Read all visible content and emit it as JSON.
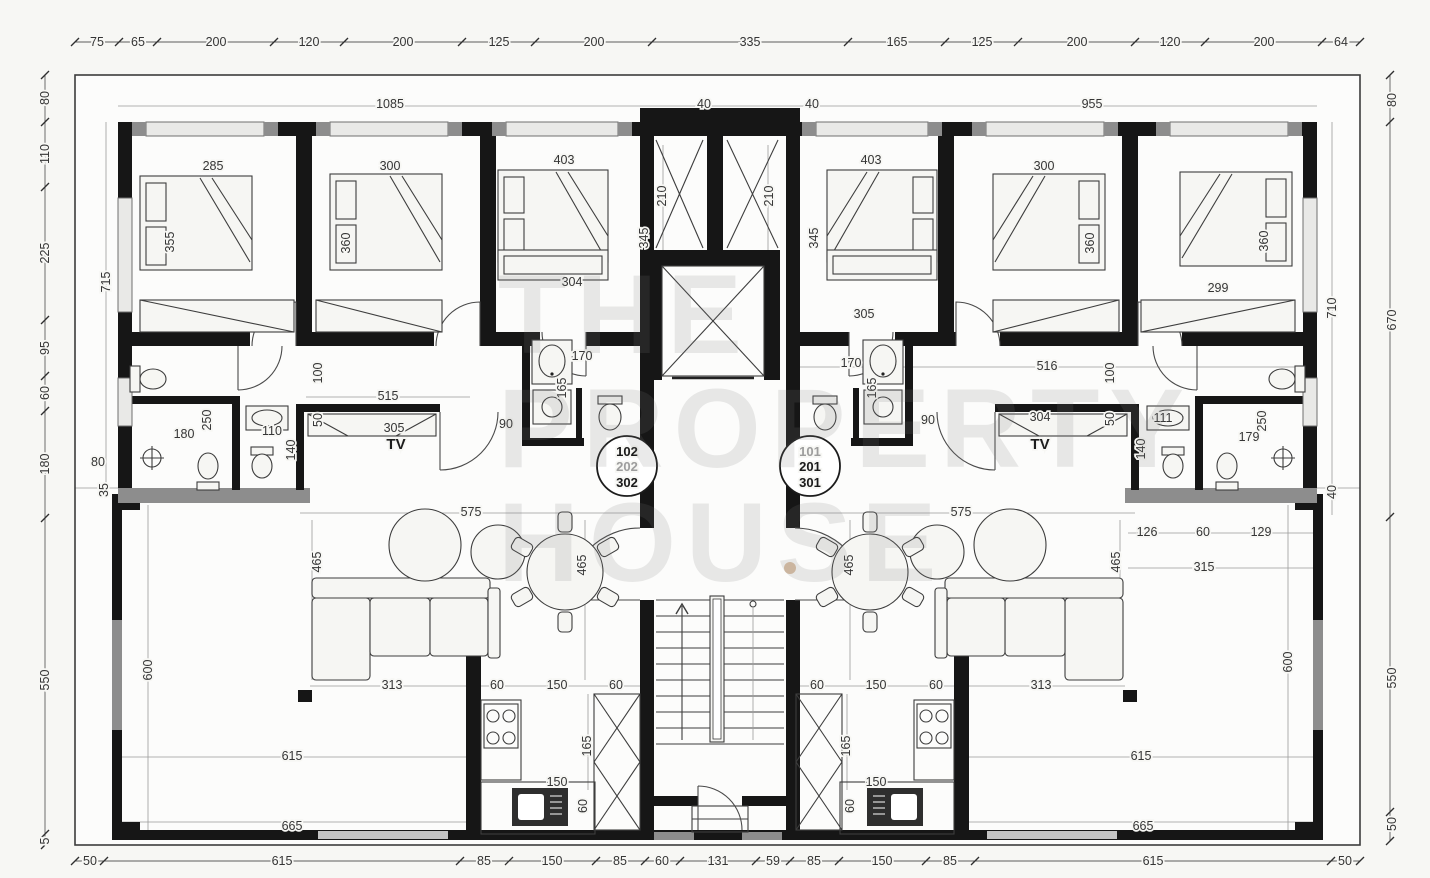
{
  "watermark": {
    "line1": "THE",
    "line2": "PROPERTY",
    "line3": "HOUSE"
  },
  "plan": {
    "kind": "apartment-floor-plan",
    "unit_stacks": {
      "left": [
        "102",
        "202",
        "302"
      ],
      "right": [
        "101",
        "201",
        "301"
      ]
    },
    "room_tags": [
      "TV",
      "TV"
    ]
  },
  "labels": [
    {
      "t": "75",
      "x": 97,
      "y": 42
    },
    {
      "t": "65",
      "x": 138,
      "y": 42
    },
    {
      "t": "200",
      "x": 216,
      "y": 42
    },
    {
      "t": "120",
      "x": 309,
      "y": 42
    },
    {
      "t": "200",
      "x": 403,
      "y": 42
    },
    {
      "t": "125",
      "x": 499,
      "y": 42
    },
    {
      "t": "200",
      "x": 594,
      "y": 42
    },
    {
      "t": "335",
      "x": 750,
      "y": 42
    },
    {
      "t": "165",
      "x": 897,
      "y": 42
    },
    {
      "t": "125",
      "x": 982,
      "y": 42
    },
    {
      "t": "200",
      "x": 1077,
      "y": 42
    },
    {
      "t": "120",
      "x": 1170,
      "y": 42
    },
    {
      "t": "200",
      "x": 1264,
      "y": 42
    },
    {
      "t": "64",
      "x": 1341,
      "y": 42
    },
    {
      "t": "50",
      "x": 90,
      "y": 861
    },
    {
      "t": "615",
      "x": 282,
      "y": 861
    },
    {
      "t": "85",
      "x": 484,
      "y": 861
    },
    {
      "t": "150",
      "x": 552,
      "y": 861
    },
    {
      "t": "85",
      "x": 620,
      "y": 861
    },
    {
      "t": "60",
      "x": 662,
      "y": 861
    },
    {
      "t": "131",
      "x": 718,
      "y": 861
    },
    {
      "t": "59",
      "x": 773,
      "y": 861
    },
    {
      "t": "85",
      "x": 814,
      "y": 861
    },
    {
      "t": "150",
      "x": 882,
      "y": 861
    },
    {
      "t": "85",
      "x": 950,
      "y": 861
    },
    {
      "t": "615",
      "x": 1153,
      "y": 861
    },
    {
      "t": "50",
      "x": 1345,
      "y": 861
    },
    {
      "t": "80",
      "x": 45,
      "y": 98,
      "r": 1
    },
    {
      "t": "110",
      "x": 45,
      "y": 154,
      "r": 1
    },
    {
      "t": "225",
      "x": 45,
      "y": 253,
      "r": 1
    },
    {
      "t": "95",
      "x": 45,
      "y": 348,
      "r": 1
    },
    {
      "t": "60",
      "x": 45,
      "y": 393,
      "r": 1
    },
    {
      "t": "180",
      "x": 45,
      "y": 464,
      "r": 1
    },
    {
      "t": "550",
      "x": 45,
      "y": 680,
      "r": 1
    },
    {
      "t": "5",
      "x": 45,
      "y": 841,
      "r": 1
    },
    {
      "t": "80",
      "x": 1392,
      "y": 100,
      "r": 1
    },
    {
      "t": "670",
      "x": 1392,
      "y": 320,
      "r": 1
    },
    {
      "t": "550",
      "x": 1392,
      "y": 678,
      "r": 1
    },
    {
      "t": "50",
      "x": 1392,
      "y": 824,
      "r": 1
    },
    {
      "t": "1085",
      "x": 390,
      "y": 104
    },
    {
      "t": "40",
      "x": 704,
      "y": 104
    },
    {
      "t": "40",
      "x": 812,
      "y": 104
    },
    {
      "t": "955",
      "x": 1092,
      "y": 104
    },
    {
      "t": "715",
      "x": 106,
      "y": 282,
      "r": 1
    },
    {
      "t": "80",
      "x": 98,
      "y": 462
    },
    {
      "t": "35",
      "x": 104,
      "y": 490,
      "r": 1
    },
    {
      "t": "600",
      "x": 148,
      "y": 670,
      "r": 1
    },
    {
      "t": "665",
      "x": 292,
      "y": 826
    },
    {
      "t": "710",
      "x": 1332,
      "y": 308,
      "r": 1
    },
    {
      "t": "40",
      "x": 1332,
      "y": 492,
      "r": 1
    },
    {
      "t": "600",
      "x": 1288,
      "y": 662,
      "r": 1
    },
    {
      "t": "665",
      "x": 1143,
      "y": 826
    },
    {
      "t": "285",
      "x": 213,
      "y": 166
    },
    {
      "t": "355",
      "x": 170,
      "y": 242,
      "r": 1
    },
    {
      "t": "300",
      "x": 390,
      "y": 166
    },
    {
      "t": "360",
      "x": 346,
      "y": 243,
      "r": 1
    },
    {
      "t": "403",
      "x": 564,
      "y": 160
    },
    {
      "t": "304",
      "x": 572,
      "y": 282
    },
    {
      "t": "210",
      "x": 662,
      "y": 196,
      "r": 1
    },
    {
      "t": "345",
      "x": 644,
      "y": 238,
      "r": 1
    },
    {
      "t": "210",
      "x": 769,
      "y": 196,
      "r": 1
    },
    {
      "t": "345",
      "x": 814,
      "y": 238,
      "r": 1
    },
    {
      "t": "403",
      "x": 871,
      "y": 160
    },
    {
      "t": "305",
      "x": 864,
      "y": 314
    },
    {
      "t": "300",
      "x": 1044,
      "y": 166
    },
    {
      "t": "360",
      "x": 1090,
      "y": 243,
      "r": 1
    },
    {
      "t": "299",
      "x": 1218,
      "y": 288
    },
    {
      "t": "360",
      "x": 1264,
      "y": 241,
      "r": 1
    },
    {
      "t": "100",
      "x": 318,
      "y": 373,
      "r": 1
    },
    {
      "t": "515",
      "x": 388,
      "y": 396
    },
    {
      "t": "50",
      "x": 318,
      "y": 420,
      "r": 1
    },
    {
      "t": "305",
      "x": 394,
      "y": 428
    },
    {
      "t": "TV",
      "x": 396,
      "y": 445,
      "c": "tv"
    },
    {
      "t": "250",
      "x": 207,
      "y": 420,
      "r": 1
    },
    {
      "t": "180",
      "x": 184,
      "y": 434
    },
    {
      "t": "110",
      "x": 272,
      "y": 431
    },
    {
      "t": "140",
      "x": 291,
      "y": 450,
      "r": 1
    },
    {
      "t": "170",
      "x": 582,
      "y": 356
    },
    {
      "t": "165",
      "x": 562,
      "y": 388,
      "r": 1
    },
    {
      "t": "90",
      "x": 506,
      "y": 424
    },
    {
      "t": "516",
      "x": 1047,
      "y": 366
    },
    {
      "t": "100",
      "x": 1110,
      "y": 373,
      "r": 1
    },
    {
      "t": "50",
      "x": 1110,
      "y": 419,
      "r": 1
    },
    {
      "t": "304",
      "x": 1040,
      "y": 417
    },
    {
      "t": "TV",
      "x": 1040,
      "y": 445,
      "c": "tv"
    },
    {
      "t": "90",
      "x": 928,
      "y": 420
    },
    {
      "t": "170",
      "x": 851,
      "y": 363
    },
    {
      "t": "165",
      "x": 872,
      "y": 388,
      "r": 1
    },
    {
      "t": "111",
      "x": 1163,
      "y": 418
    },
    {
      "t": "140",
      "x": 1141,
      "y": 449,
      "r": 1
    },
    {
      "t": "250",
      "x": 1262,
      "y": 421,
      "r": 1
    },
    {
      "t": "179",
      "x": 1249,
      "y": 437
    },
    {
      "t": "575",
      "x": 471,
      "y": 512
    },
    {
      "t": "465",
      "x": 317,
      "y": 562,
      "r": 1
    },
    {
      "t": "465",
      "x": 582,
      "y": 565,
      "r": 1
    },
    {
      "t": "313",
      "x": 392,
      "y": 685
    },
    {
      "t": "60",
      "x": 497,
      "y": 685
    },
    {
      "t": "150",
      "x": 557,
      "y": 685
    },
    {
      "t": "60",
      "x": 616,
      "y": 685
    },
    {
      "t": "165",
      "x": 587,
      "y": 746,
      "r": 1
    },
    {
      "t": "150",
      "x": 557,
      "y": 782
    },
    {
      "t": "60",
      "x": 583,
      "y": 806,
      "r": 1
    },
    {
      "t": "615",
      "x": 292,
      "y": 756
    },
    {
      "t": "575",
      "x": 961,
      "y": 512
    },
    {
      "t": "465",
      "x": 849,
      "y": 565,
      "r": 1
    },
    {
      "t": "465",
      "x": 1116,
      "y": 562,
      "r": 1
    },
    {
      "t": "313",
      "x": 1041,
      "y": 685
    },
    {
      "t": "60",
      "x": 936,
      "y": 685
    },
    {
      "t": "150",
      "x": 876,
      "y": 685
    },
    {
      "t": "60",
      "x": 817,
      "y": 685
    },
    {
      "t": "165",
      "x": 846,
      "y": 746,
      "r": 1
    },
    {
      "t": "150",
      "x": 876,
      "y": 782
    },
    {
      "t": "60",
      "x": 850,
      "y": 806,
      "r": 1
    },
    {
      "t": "615",
      "x": 1141,
      "y": 756
    },
    {
      "t": "126",
      "x": 1147,
      "y": 532
    },
    {
      "t": "60",
      "x": 1203,
      "y": 532
    },
    {
      "t": "129",
      "x": 1261,
      "y": 532
    },
    {
      "t": "315",
      "x": 1204,
      "y": 567
    },
    {
      "t": "102",
      "x": 627,
      "y": 452,
      "c": "ub",
      "n": "unit-number"
    },
    {
      "t": "202",
      "x": 627,
      "y": 467,
      "c": "ug",
      "n": "unit-number"
    },
    {
      "t": "302",
      "x": 627,
      "y": 483,
      "c": "ub",
      "n": "unit-number"
    },
    {
      "t": "101",
      "x": 810,
      "y": 452,
      "c": "ug",
      "n": "unit-number"
    },
    {
      "t": "201",
      "x": 810,
      "y": 467,
      "c": "ub",
      "n": "unit-number"
    },
    {
      "t": "301",
      "x": 810,
      "y": 483,
      "c": "ub",
      "n": "unit-number"
    }
  ]
}
